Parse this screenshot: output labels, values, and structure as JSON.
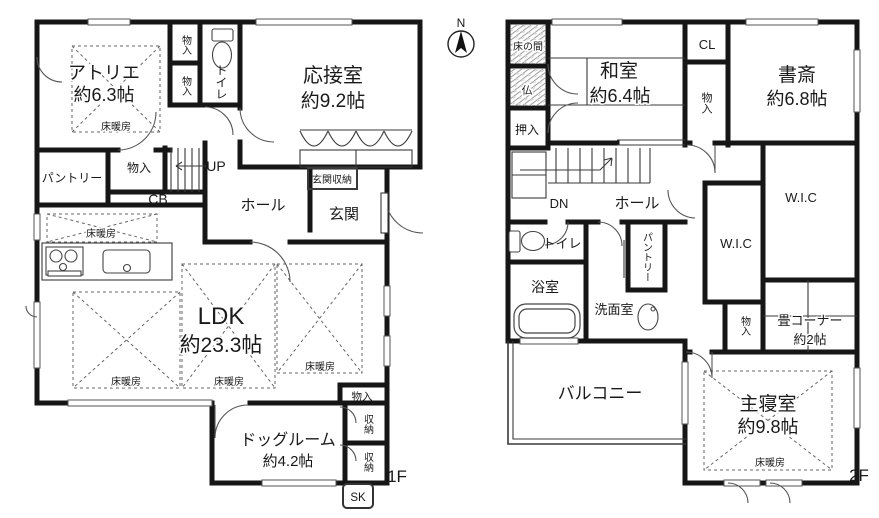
{
  "meta": {
    "floor1_label": "1F",
    "floor2_label": "2F",
    "compass": "N"
  },
  "common": {
    "yukadanbo": "床暖房",
    "monoiri": "物入",
    "toire": "トイレ",
    "shuno": "収納",
    "wic": "W.I.C",
    "pantry": "パントリー",
    "hall": "ホール"
  },
  "f1": {
    "atelier": "アトリエ",
    "atelier_size": "約6.3帖",
    "ousetsu": "応接室",
    "ousetsu_size": "約9.2帖",
    "up": "UP",
    "cb": "CB",
    "genkan_shuno": "玄関収納",
    "genkan": "玄関",
    "ldk": "LDK",
    "ldk_size": "約23.3帖",
    "dog": "ドッグルーム",
    "dog_size": "約4.2帖",
    "sk": "SK"
  },
  "f2": {
    "tokonoma": "床の間",
    "butsu": "仏",
    "oshiire": "押入",
    "washitsu": "和室",
    "washitsu_size": "約6.4帖",
    "cl": "CL",
    "shosai": "書斎",
    "shosai_size": "約6.8帖",
    "dn": "DN",
    "yokushitsu": "浴室",
    "senmen": "洗面室",
    "tatami": "畳コーナー",
    "tatami_size": "約2帖",
    "balcony": "バルコニー",
    "shushin": "主寝室",
    "shushin_size": "約9.8帖"
  }
}
